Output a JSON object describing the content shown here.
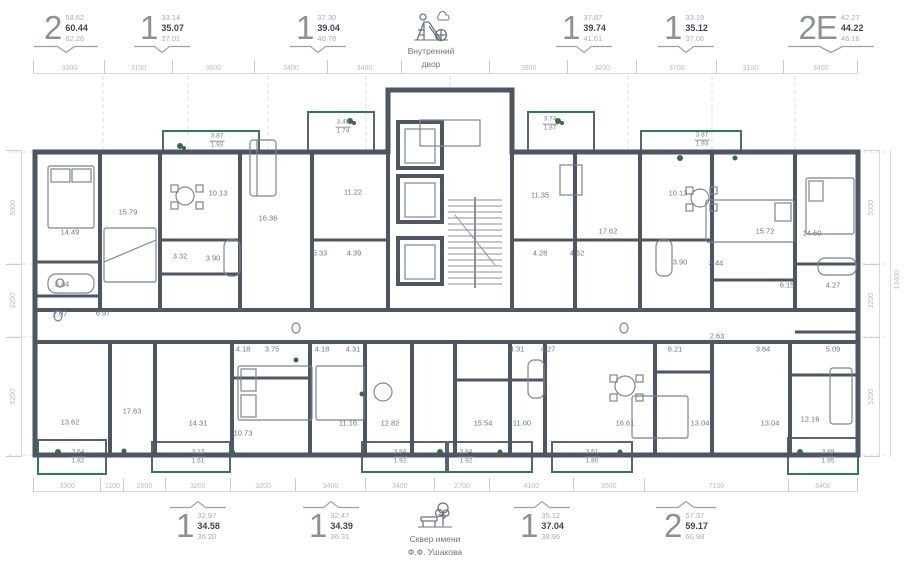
{
  "header": {
    "apartments": [
      {
        "type": "2",
        "area_min": "58.62",
        "area_mid": "60.44",
        "area_max": "62.26"
      },
      {
        "type": "1",
        "area_min": "33.14",
        "area_mid": "35.07",
        "area_max": "37.01"
      },
      {
        "type": "1",
        "area_min": "37.30",
        "area_mid": "39.04",
        "area_max": "40.78"
      },
      {
        "type": "1",
        "area_min": "37.87",
        "area_mid": "39.74",
        "area_max": "41.61"
      },
      {
        "type": "1",
        "area_min": "33.19",
        "area_mid": "35.12",
        "area_max": "37.06"
      },
      {
        "type": "2Е",
        "area_min": "42.27",
        "area_mid": "44.22",
        "area_max": "46.16"
      }
    ],
    "courtyard_line1": "Внутренний",
    "courtyard_line2": "двор"
  },
  "footer": {
    "apartments": [
      {
        "type": "1",
        "area_min": "32.97",
        "area_mid": "34.58",
        "area_max": "36.20"
      },
      {
        "type": "1",
        "area_min": "32.47",
        "area_mid": "34.39",
        "area_max": "36.31"
      },
      {
        "type": "1",
        "area_min": "35.12",
        "area_mid": "37.04",
        "area_max": "38.96"
      },
      {
        "type": "2",
        "area_min": "57.37",
        "area_mid": "59.17",
        "area_max": "60.98"
      }
    ],
    "park_line1": "Сквер имени",
    "park_line2": "Ф.Ф. Ушакова"
  },
  "dimensions": {
    "top": [
      {
        "label": "3300",
        "mm": 3300
      },
      {
        "label": "3100",
        "mm": 3100
      },
      {
        "label": "3800",
        "mm": 3800
      },
      {
        "label": "3400",
        "mm": 3400
      },
      {
        "label": "3400",
        "mm": 3400
      },
      {
        "label": "",
        "mm": 4100
      },
      {
        "label": "3600",
        "mm": 3600
      },
      {
        "label": "3200",
        "mm": 3200
      },
      {
        "label": "3700",
        "mm": 3700
      },
      {
        "label": "3100",
        "mm": 3100
      },
      {
        "label": "3400",
        "mm": 3400
      }
    ],
    "bottom": [
      {
        "label": "3300",
        "mm": 3300
      },
      {
        "label": "1100",
        "mm": 1100
      },
      {
        "label": "2000",
        "mm": 2000
      },
      {
        "label": "3200",
        "mm": 3200
      },
      {
        "label": "3200",
        "mm": 3200
      },
      {
        "label": "3400",
        "mm": 3400
      },
      {
        "label": "3400",
        "mm": 3400
      },
      {
        "label": "2700",
        "mm": 2700
      },
      {
        "label": "4100",
        "mm": 4100
      },
      {
        "label": "3500",
        "mm": 3500
      },
      {
        "label": "7100",
        "mm": 7100
      },
      {
        "label": "3400",
        "mm": 3400
      }
    ],
    "left": [
      {
        "label": "5000",
        "mm": 5000
      },
      {
        "label": "3200",
        "mm": 3200
      },
      {
        "label": "5200",
        "mm": 5200
      }
    ],
    "right": [
      {
        "label": "5000",
        "mm": 5000
      },
      {
        "label": "3200",
        "mm": 3200
      },
      {
        "label": "5200",
        "mm": 5200
      }
    ],
    "right_overall": "13400"
  },
  "plan": {
    "colors": {
      "wall": "#4d5662",
      "furniture": "#7b8590",
      "balcony_glass": "#2e7d4f",
      "plant": "#3a6b45",
      "dashed": "#dcdfe2"
    },
    "rooms": [
      {
        "x": 70,
        "y": 232,
        "a": "14.49"
      },
      {
        "x": 128,
        "y": 212,
        "a": "15.79"
      },
      {
        "x": 62,
        "y": 284,
        "a": "3.84"
      },
      {
        "x": 60,
        "y": 314,
        "a": "2.07"
      },
      {
        "x": 103,
        "y": 313,
        "a": "6.97"
      },
      {
        "x": 180,
        "y": 256,
        "a": "3.32"
      },
      {
        "x": 218,
        "y": 193,
        "a": "10.13"
      },
      {
        "x": 213,
        "y": 258,
        "a": "3.90"
      },
      {
        "x": 268,
        "y": 218,
        "a": "16.36"
      },
      {
        "x": 320,
        "y": 253,
        "a": "5.33"
      },
      {
        "x": 354,
        "y": 253,
        "a": "4.39"
      },
      {
        "x": 353,
        "y": 192,
        "a": "11.22"
      },
      {
        "x": 540,
        "y": 195,
        "a": "11.35"
      },
      {
        "x": 540,
        "y": 253,
        "a": "4.28"
      },
      {
        "x": 577,
        "y": 253,
        "a": "4.62"
      },
      {
        "x": 608,
        "y": 231,
        "a": "17.62"
      },
      {
        "x": 678,
        "y": 193,
        "a": "10.13"
      },
      {
        "x": 680,
        "y": 262,
        "a": "3.90"
      },
      {
        "x": 716,
        "y": 263,
        "a": "3.44"
      },
      {
        "x": 765,
        "y": 231,
        "a": "15.72"
      },
      {
        "x": 787,
        "y": 285,
        "a": "6.15"
      },
      {
        "x": 812,
        "y": 233,
        "a": "14.60"
      },
      {
        "x": 833,
        "y": 285,
        "a": "4.27"
      },
      {
        "x": 717,
        "y": 336,
        "a": "2.63"
      },
      {
        "x": 763,
        "y": 349,
        "a": "3.84"
      },
      {
        "x": 833,
        "y": 349,
        "a": "5.09"
      },
      {
        "x": 70,
        "y": 422,
        "a": "13.62"
      },
      {
        "x": 132,
        "y": 411,
        "a": "17.63"
      },
      {
        "x": 243,
        "y": 349,
        "a": "4.18"
      },
      {
        "x": 272,
        "y": 349,
        "a": "3.75"
      },
      {
        "x": 322,
        "y": 349,
        "a": "4.18"
      },
      {
        "x": 353,
        "y": 349,
        "a": "4.31"
      },
      {
        "x": 198,
        "y": 423,
        "a": "14.31"
      },
      {
        "x": 243,
        "y": 433,
        "a": "10.73"
      },
      {
        "x": 348,
        "y": 423,
        "a": "11.16"
      },
      {
        "x": 390,
        "y": 423,
        "a": "12.82"
      },
      {
        "x": 517,
        "y": 349,
        "a": "4.31"
      },
      {
        "x": 548,
        "y": 349,
        "a": "4.27"
      },
      {
        "x": 483,
        "y": 423,
        "a": "15.54"
      },
      {
        "x": 522,
        "y": 423,
        "a": "11.00"
      },
      {
        "x": 625,
        "y": 423,
        "a": "16.61"
      },
      {
        "x": 675,
        "y": 349,
        "a": "8.21"
      },
      {
        "x": 700,
        "y": 423,
        "a": "13.04"
      },
      {
        "x": 770,
        "y": 423,
        "a": "13.04"
      },
      {
        "x": 810,
        "y": 419,
        "a": "12.16"
      }
    ],
    "balconies": [
      {
        "x": 217,
        "y": 141,
        "a": "3.87",
        "b": "1.93"
      },
      {
        "x": 343,
        "y": 127,
        "a": "3.48",
        "b": "1.74"
      },
      {
        "x": 550,
        "y": 124,
        "a": "3.74",
        "b": "1.87"
      },
      {
        "x": 702,
        "y": 140,
        "a": "3.87",
        "b": "1.93"
      },
      {
        "x": 78,
        "y": 457,
        "a": "3.64",
        "b": "1.82"
      },
      {
        "x": 198,
        "y": 457,
        "a": "3.23",
        "b": "1.61"
      },
      {
        "x": 400,
        "y": 457,
        "a": "3.84",
        "b": "1.92"
      },
      {
        "x": 466,
        "y": 457,
        "a": "3.84",
        "b": "1.92"
      },
      {
        "x": 592,
        "y": 457,
        "a": "3.61",
        "b": "1.80"
      },
      {
        "x": 828,
        "y": 457,
        "a": "3.89",
        "b": "1.95"
      }
    ]
  }
}
